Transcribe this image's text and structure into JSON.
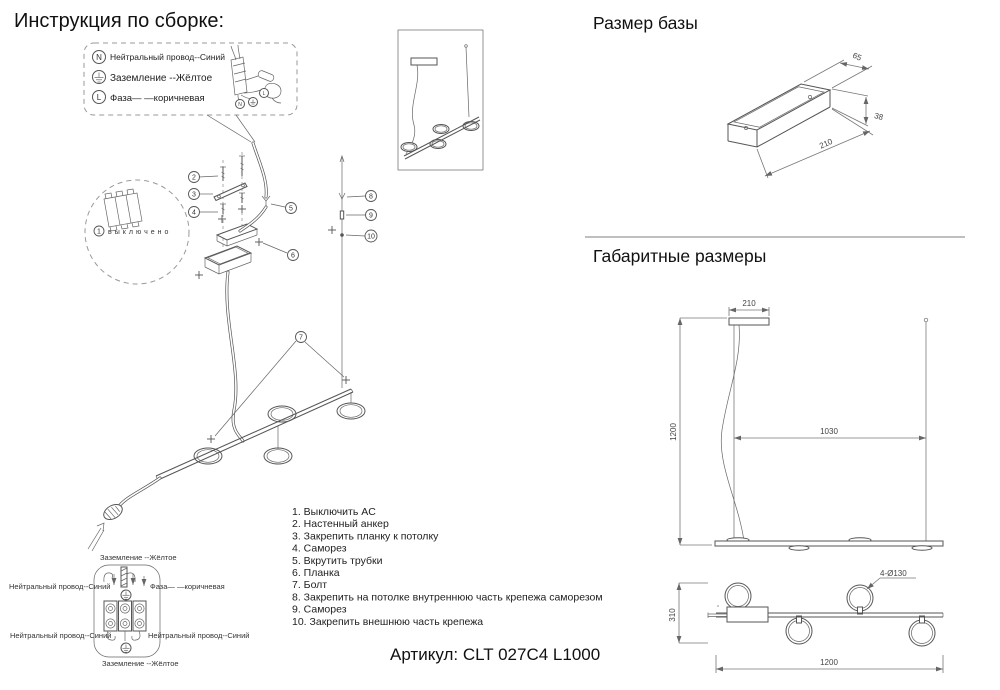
{
  "header": {
    "title": "Инструкция по сборке:"
  },
  "legend": {
    "items": [
      {
        "symbol": "N",
        "label": "Нейтральный провод--Синий"
      },
      {
        "symbol": "ground",
        "label": "Заземление --Жёлтое"
      },
      {
        "symbol": "L",
        "label": "Фаза— —коричневая"
      }
    ],
    "mini": {
      "n": "N",
      "l": "L"
    }
  },
  "breaker": {
    "num": "1",
    "label": "выключено"
  },
  "callouts": {
    "c2": "2",
    "c3": "3",
    "c4": "4",
    "c5": "5",
    "c6": "6",
    "c7": "7",
    "c8": "8",
    "c9": "9",
    "c10": "10"
  },
  "steps": [
    "1. Выключить AC",
    "2. Настенный анкер",
    "3. Закрепить планку к потолку",
    "4. Саморез",
    "5. Вкрутить трубки",
    "6. Планка",
    "7. Болт",
    "8. Закрепить на потолке внутреннюю часть крепежа саморезом",
    "9. Саморез",
    "10. Закрепить внешнюю часть крепежа"
  ],
  "wiring": {
    "ground_top": "Заземление --Жёлтое",
    "neutral_left": "Нейтральный провод--Синий",
    "phase": "Фаза— —коричневая",
    "neutral_bottom_left": "Нейтральный провод--Синий",
    "neutral_bottom_right": "Нейтральный провод--Синий",
    "ground_bottom": "Заземление --Жёлтое"
  },
  "base": {
    "title": "Размер базы",
    "dim_width": "65",
    "dim_height": "38",
    "dim_length": "210"
  },
  "overall": {
    "title": "Габаритные размеры",
    "canopy": "210",
    "height": "1200",
    "span": "1030",
    "ring_drop": "310",
    "length": "1200",
    "ring_note": "4-Ø130"
  },
  "footer": {
    "article": "Артикул: CLT 027C4 L1000"
  }
}
